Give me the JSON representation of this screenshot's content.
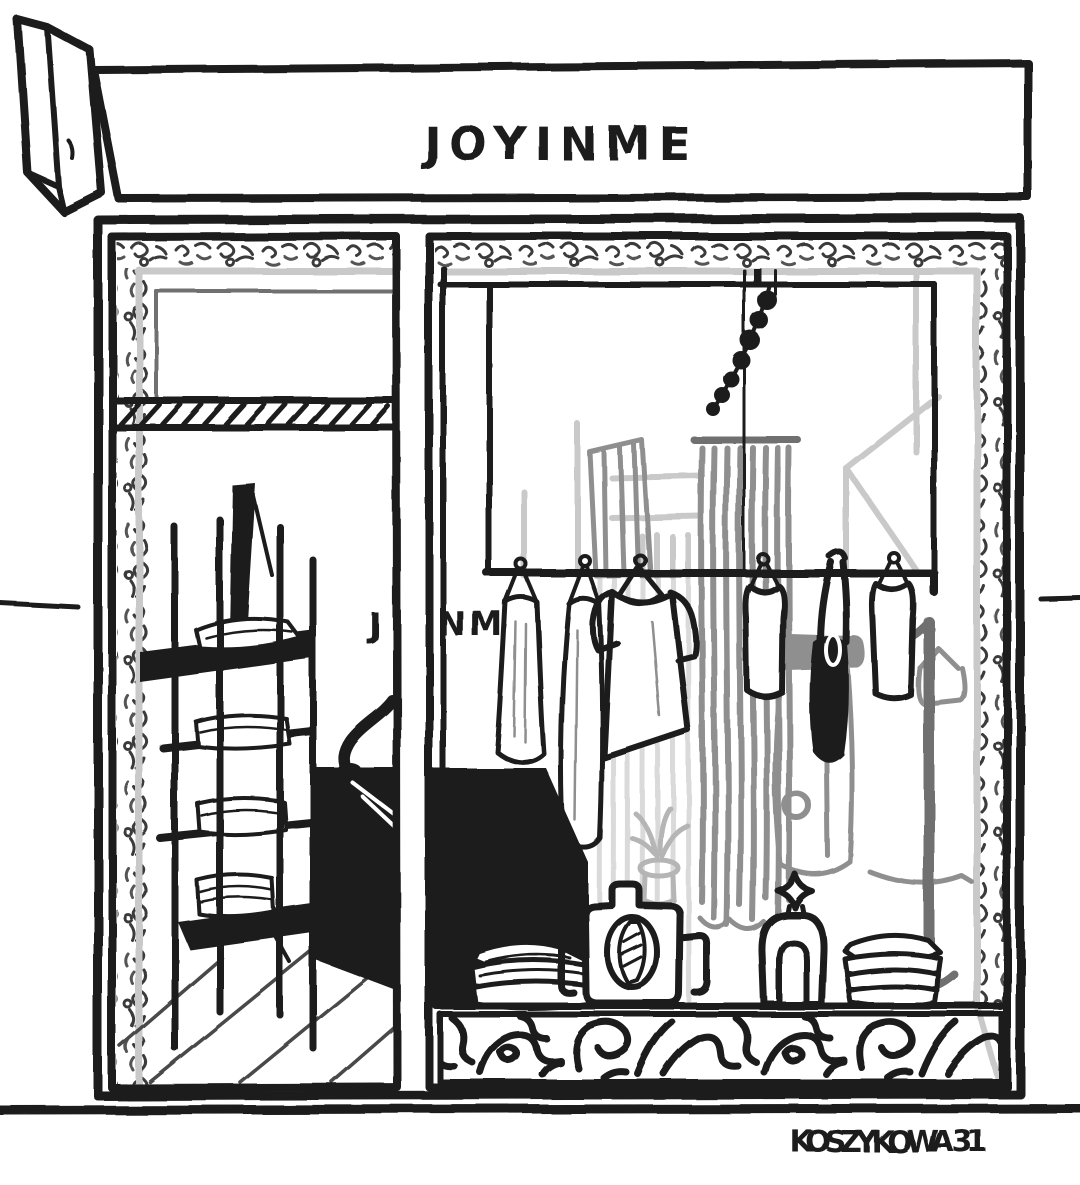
{
  "canvas": {
    "width": 1080,
    "height": 1185
  },
  "palette": {
    "ink": "#1b1b1b",
    "paper": "#ffffff",
    "gray_dark": "#6f6f6f",
    "gray_mid": "#8f8f8f",
    "gray_light": "#c9c9c9",
    "gray_pale": "#dadada"
  },
  "texts": {
    "store_name": "JOYINME",
    "interior_sign_left": "J",
    "interior_sign_right": "NME",
    "address": "KOSZYKOWA 31"
  }
}
